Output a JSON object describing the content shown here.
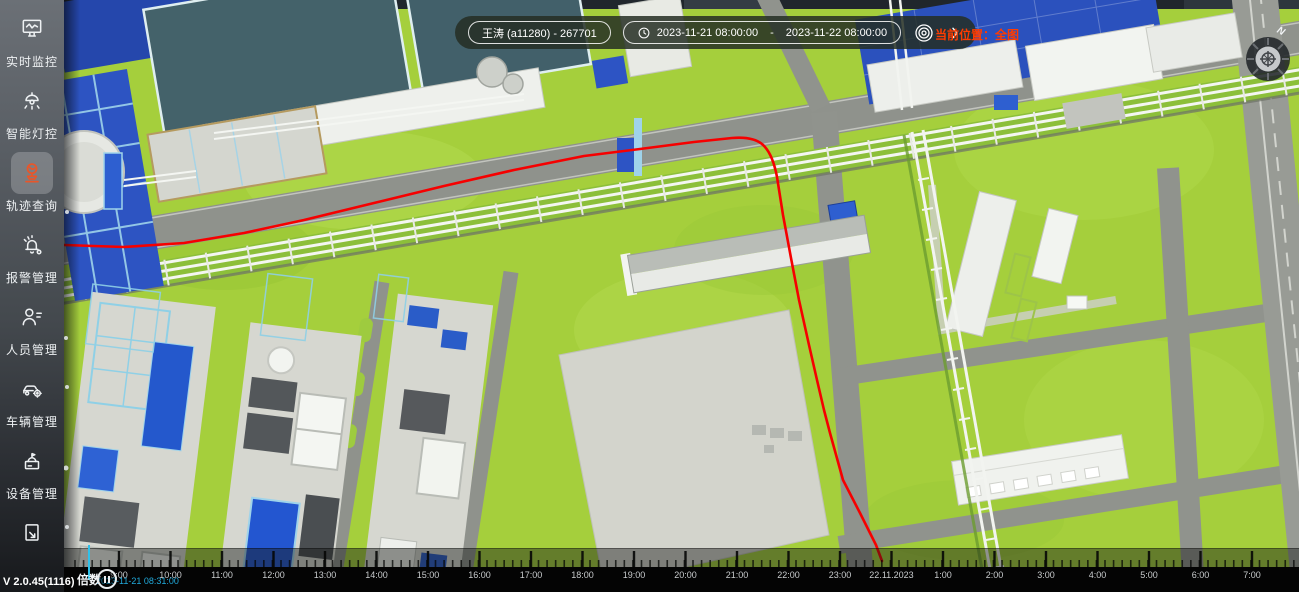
{
  "sidebar": {
    "items": [
      {
        "label": "实时监控",
        "icon": "realtime-monitor-icon",
        "active": false
      },
      {
        "label": "智能灯控",
        "icon": "smart-light-icon",
        "active": false
      },
      {
        "label": "轨迹查询",
        "icon": "trajectory-query-icon",
        "active": true
      },
      {
        "label": "报警管理",
        "icon": "alarm-manage-icon",
        "active": false
      },
      {
        "label": "人员管理",
        "icon": "personnel-manage-icon",
        "active": false
      },
      {
        "label": "车辆管理",
        "icon": "vehicle-manage-icon",
        "active": false
      },
      {
        "label": "设备管理",
        "icon": "device-manage-icon",
        "active": false
      },
      {
        "label": "",
        "icon": "map-export-icon",
        "active": false
      }
    ],
    "version": "V 2.0.45(1116)",
    "active_icon_color": "#e8562a"
  },
  "topbar": {
    "person": "王涛 (a11280)  - 267701",
    "date_start": "2023-11-21 08:00:00",
    "date_separator": "-",
    "date_end": "2023-11-22 08:00:00",
    "location_label": "当前位置：全图",
    "location_color": "#ff3c00"
  },
  "compass": {
    "north_label": "N"
  },
  "timeline": {
    "speed_label": "倍数",
    "current_time": "2023-11-21 08:31:00",
    "current_time_color": "#21aadc",
    "playhead_color": "#2fc1ea",
    "labels": [
      "9:00",
      "10:00",
      "11:00",
      "12:00",
      "13:00",
      "14:00",
      "15:00",
      "16:00",
      "17:00",
      "18:00",
      "19:00",
      "20:00",
      "21:00",
      "22:00",
      "23:00",
      "22.11.2023",
      "1:00",
      "2:00",
      "3:00",
      "4:00",
      "5:00",
      "6:00",
      "7:00"
    ]
  },
  "map": {
    "trajectory_color": "#f60000",
    "trajectory_path": "M0,245 L60,247 L120,243 L180,233 L240,220 L310,203 L380,186 L450,170 L520,156 L576,149 L630,142 L668,138 Q692,136 701,147 Q709,156 713,177 L719,215 L727,258 L735,300 L745,345 L753,380 L760,410 L766,433 L779,480 L796,513 L812,545 L818,561"
  }
}
